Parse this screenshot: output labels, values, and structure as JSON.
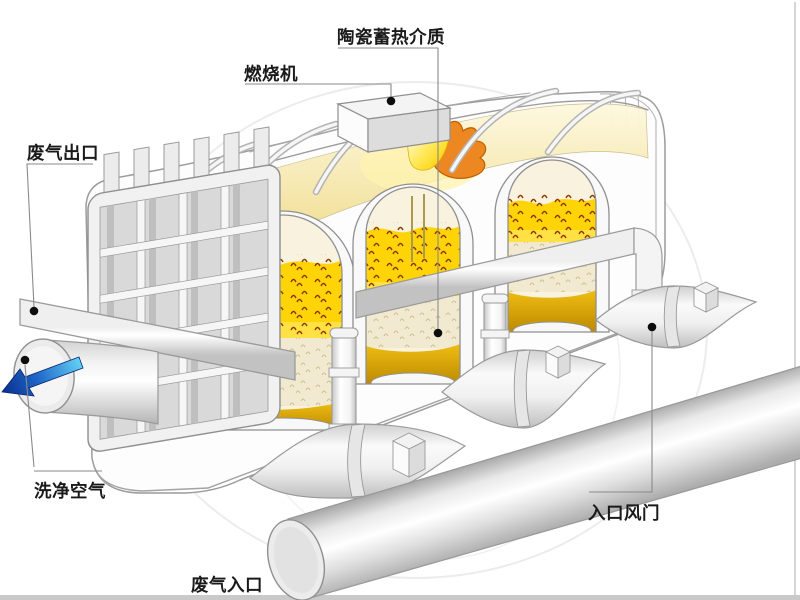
{
  "diagram": {
    "labels": {
      "ceramic_media": "陶瓷蓄热介质",
      "burner": "燃烧机",
      "exhaust_outlet": "废气出口",
      "clean_air": "洗净空气",
      "inlet_damper": "入口风门",
      "gas_inlet": "废气入口"
    },
    "colors": {
      "media_yellow": "#FFD406",
      "media_speckle": "#8F3A00",
      "media_cream": "#F1EAD0",
      "media_gold": "#D9A000",
      "flame_orange": "#ED8722",
      "flame_yellow": "#FFD40A",
      "arrow_blue_dark": "#0A2F8E",
      "arrow_blue_light": "#63D0F5",
      "body_white": "#FDFDFD",
      "outline_gray": "#9A9A9A",
      "label_text": "#1A1A1A"
    }
  }
}
